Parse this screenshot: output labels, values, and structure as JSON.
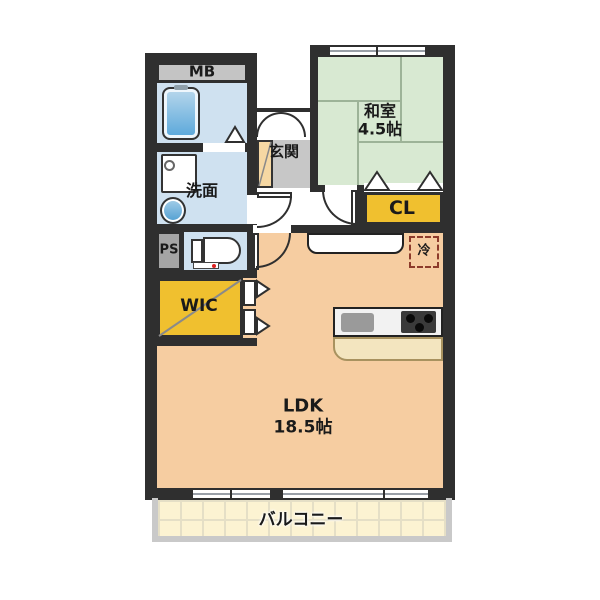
{
  "floorplan": {
    "type": "apartment-floor-plan",
    "rooms": {
      "meter_box": {
        "label": "MB"
      },
      "washroom": {
        "label": "洗面"
      },
      "pipe_space": {
        "label": "PS"
      },
      "walk_in_closet": {
        "label": "WIC"
      },
      "entrance": {
        "label": "玄関"
      },
      "japanese_room": {
        "label": "和室",
        "size": "4.5帖"
      },
      "closet": {
        "label": "CL"
      },
      "ldk": {
        "label": "LDK",
        "size": "18.5帖"
      },
      "refrigerator": {
        "label": "冷"
      },
      "balcony": {
        "label": "バルコニー"
      }
    },
    "fixtures": [
      "bathtub",
      "vanity-sink",
      "washing-machine",
      "toilet",
      "shoe-cabinet",
      "entry-double-door",
      "kitchen-counter",
      "kitchen-sink",
      "stove",
      "refrigerator-space"
    ],
    "colors": {
      "wall": "#2f2f2f",
      "ldk_floor": "#f6cda1",
      "tatami_green": "#d8e9d2",
      "closet_yellow": "#f0c02f",
      "water_blue": "#cfe1f0",
      "entrance_gray": "#c7c7c7",
      "balcony_cream": "#fcf3d2",
      "fridge_dash": "#8d3b2b"
    }
  }
}
